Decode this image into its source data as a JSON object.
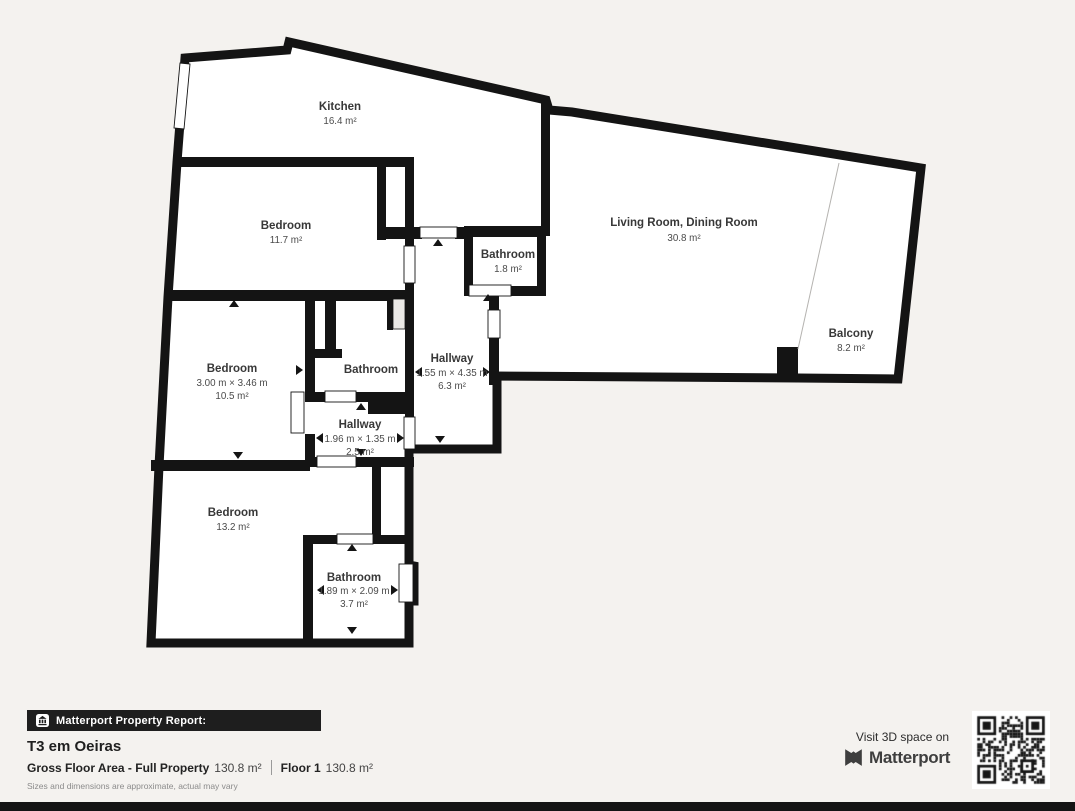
{
  "plan": {
    "rooms": [
      {
        "name": "Kitchen",
        "area": "16.4 m²"
      },
      {
        "name": "Bedroom",
        "area": "11.7 m²"
      },
      {
        "name": "Bathroom",
        "area": "1.8 m²"
      },
      {
        "name": "Living Room, Dining Room",
        "area": "30.8 m²"
      },
      {
        "name": "Balcony",
        "area": "8.2 m²"
      },
      {
        "name": "Bedroom",
        "dims": "3.00 m × 3.46 m",
        "area": "10.5 m²"
      },
      {
        "name": "Bathroom"
      },
      {
        "name": "Hallway",
        "dims": "1.55 m × 4.35 m",
        "area": "6.3 m²"
      },
      {
        "name": "Hallway",
        "dims": "1.96 m × 1.35 m",
        "area": "2.5 m²"
      },
      {
        "name": "Bedroom",
        "area": "13.2 m²"
      },
      {
        "name": "Bathroom",
        "dims": "1.89 m × 2.09 m",
        "area": "3.7 m²"
      }
    ]
  },
  "footer": {
    "report_label": "Matterport Property Report:",
    "property_title": "T3 em Oeiras",
    "gross_label": "Gross Floor Area - Full Property",
    "gross_value": "130.8 m²",
    "floor_label": "Floor 1",
    "floor_value": "130.8 m²",
    "disclaimer": "Sizes and dimensions are approximate, actual may vary",
    "cta": "Visit 3D space on",
    "brand": "Matterport"
  },
  "icons": {
    "banner_icon": "building-icon",
    "brand_icon": "matterport-logo-icon",
    "qr": "qr-code"
  },
  "colors": {
    "background": "#f4f2ef",
    "wall": "#141414",
    "floor": "#ffffff",
    "banner": "#1e1e1e",
    "label": "#383838"
  }
}
